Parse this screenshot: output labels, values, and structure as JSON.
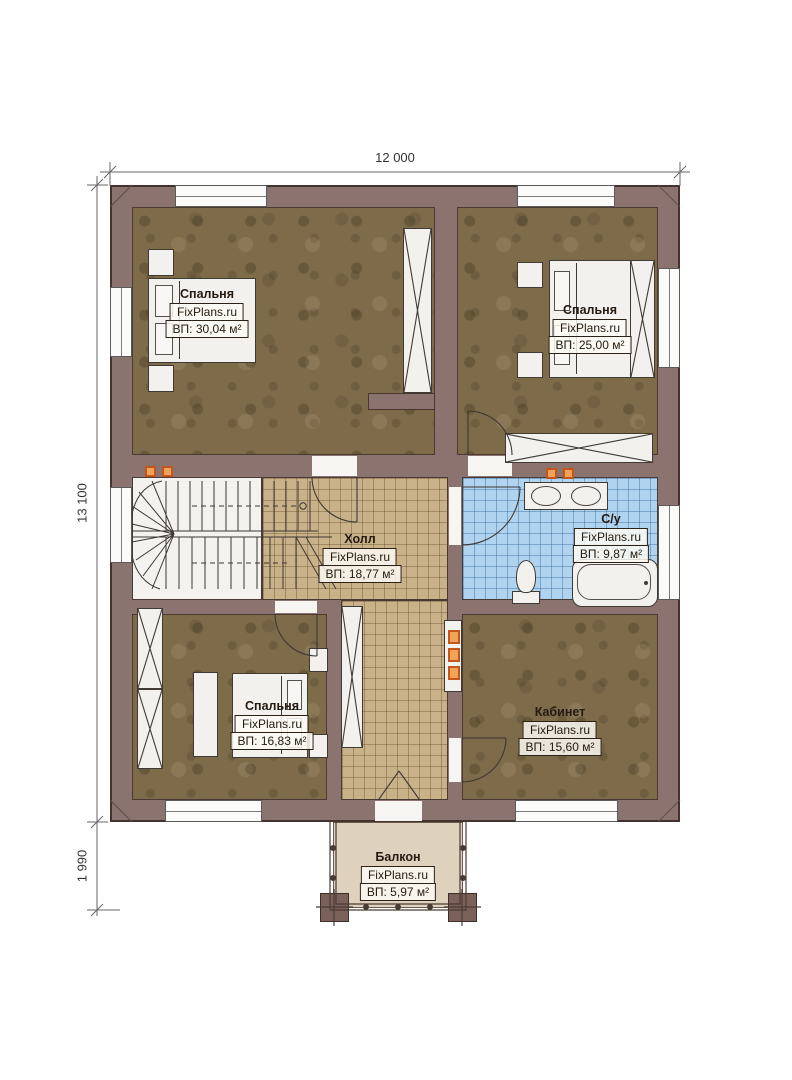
{
  "watermark": "FixPlans.ru",
  "dimensions": {
    "width_total": "12 000",
    "height_total": "13 100",
    "balcony_depth": "1 990"
  },
  "rooms": [
    {
      "id": "bedroom-top-left",
      "name": "Спальня",
      "area": "ВП: 30,04 м²"
    },
    {
      "id": "bedroom-top-right",
      "name": "Спальня",
      "area": "ВП: 25,00 м²"
    },
    {
      "id": "hall",
      "name": "Холл",
      "area": "ВП: 18,77 м²"
    },
    {
      "id": "bathroom",
      "name": "С/у",
      "area": "ВП: 9,87 м²"
    },
    {
      "id": "bedroom-bottom",
      "name": "Спальня",
      "area": "ВП: 16,83 м²"
    },
    {
      "id": "office",
      "name": "Кабинет",
      "area": "ВП: 15,60 м²"
    },
    {
      "id": "balcony",
      "name": "Балкон",
      "area": "ВП: 5,97 м²"
    }
  ],
  "colors": {
    "wall": "#8b7370",
    "wood_floor": "#7d6b4a",
    "hall_tile": "#c9b189",
    "bath_tile": "#b0d4f0",
    "balcony_floor": "#ded2bf",
    "accent_orange": "#e8762a"
  }
}
